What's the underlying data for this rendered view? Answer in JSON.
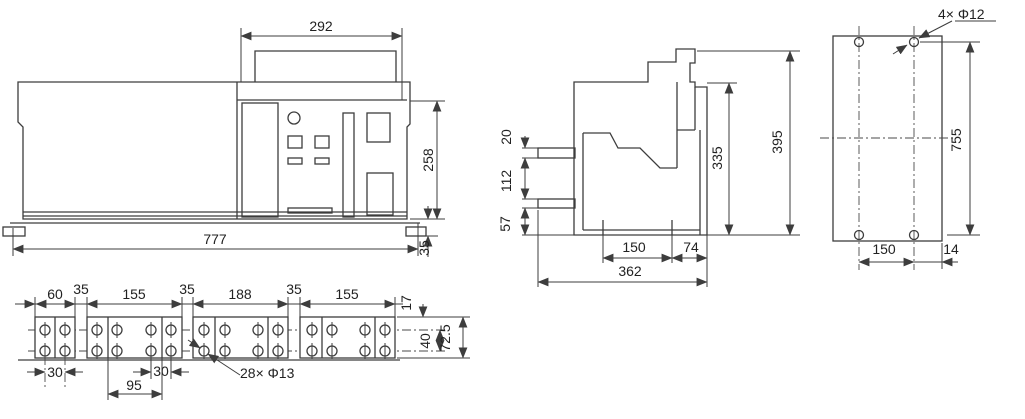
{
  "front": {
    "panel_width": "292",
    "panel_height": "258",
    "overall_width": "777",
    "base_height": "35"
  },
  "side": {
    "terminal_thickness": "20",
    "terminal_spacing": "112",
    "bottom_offset": "57",
    "body_height": "335",
    "overall_height": "395",
    "mount_spacing": "150",
    "rear_offset": "74",
    "overall_depth": "362"
  },
  "rear": {
    "mount_hole_callout": "4× Φ12",
    "hole_vertical_spacing": "755",
    "hole_horizontal_spacing": "150",
    "edge_offset": "14"
  },
  "terminal": {
    "bar1_width": "60",
    "gap1": "35",
    "bar2_width": "155",
    "gap2": "35",
    "bar3_width": "188",
    "gap3": "35",
    "bar4_width": "155",
    "top_offset": "17",
    "row_spacing": "40",
    "strip_height": "72.5",
    "hole_pitch_1": "30",
    "hole_pitch_2": "30",
    "hole_pitch_wide": "95",
    "hole_callout": "28× Φ13"
  }
}
